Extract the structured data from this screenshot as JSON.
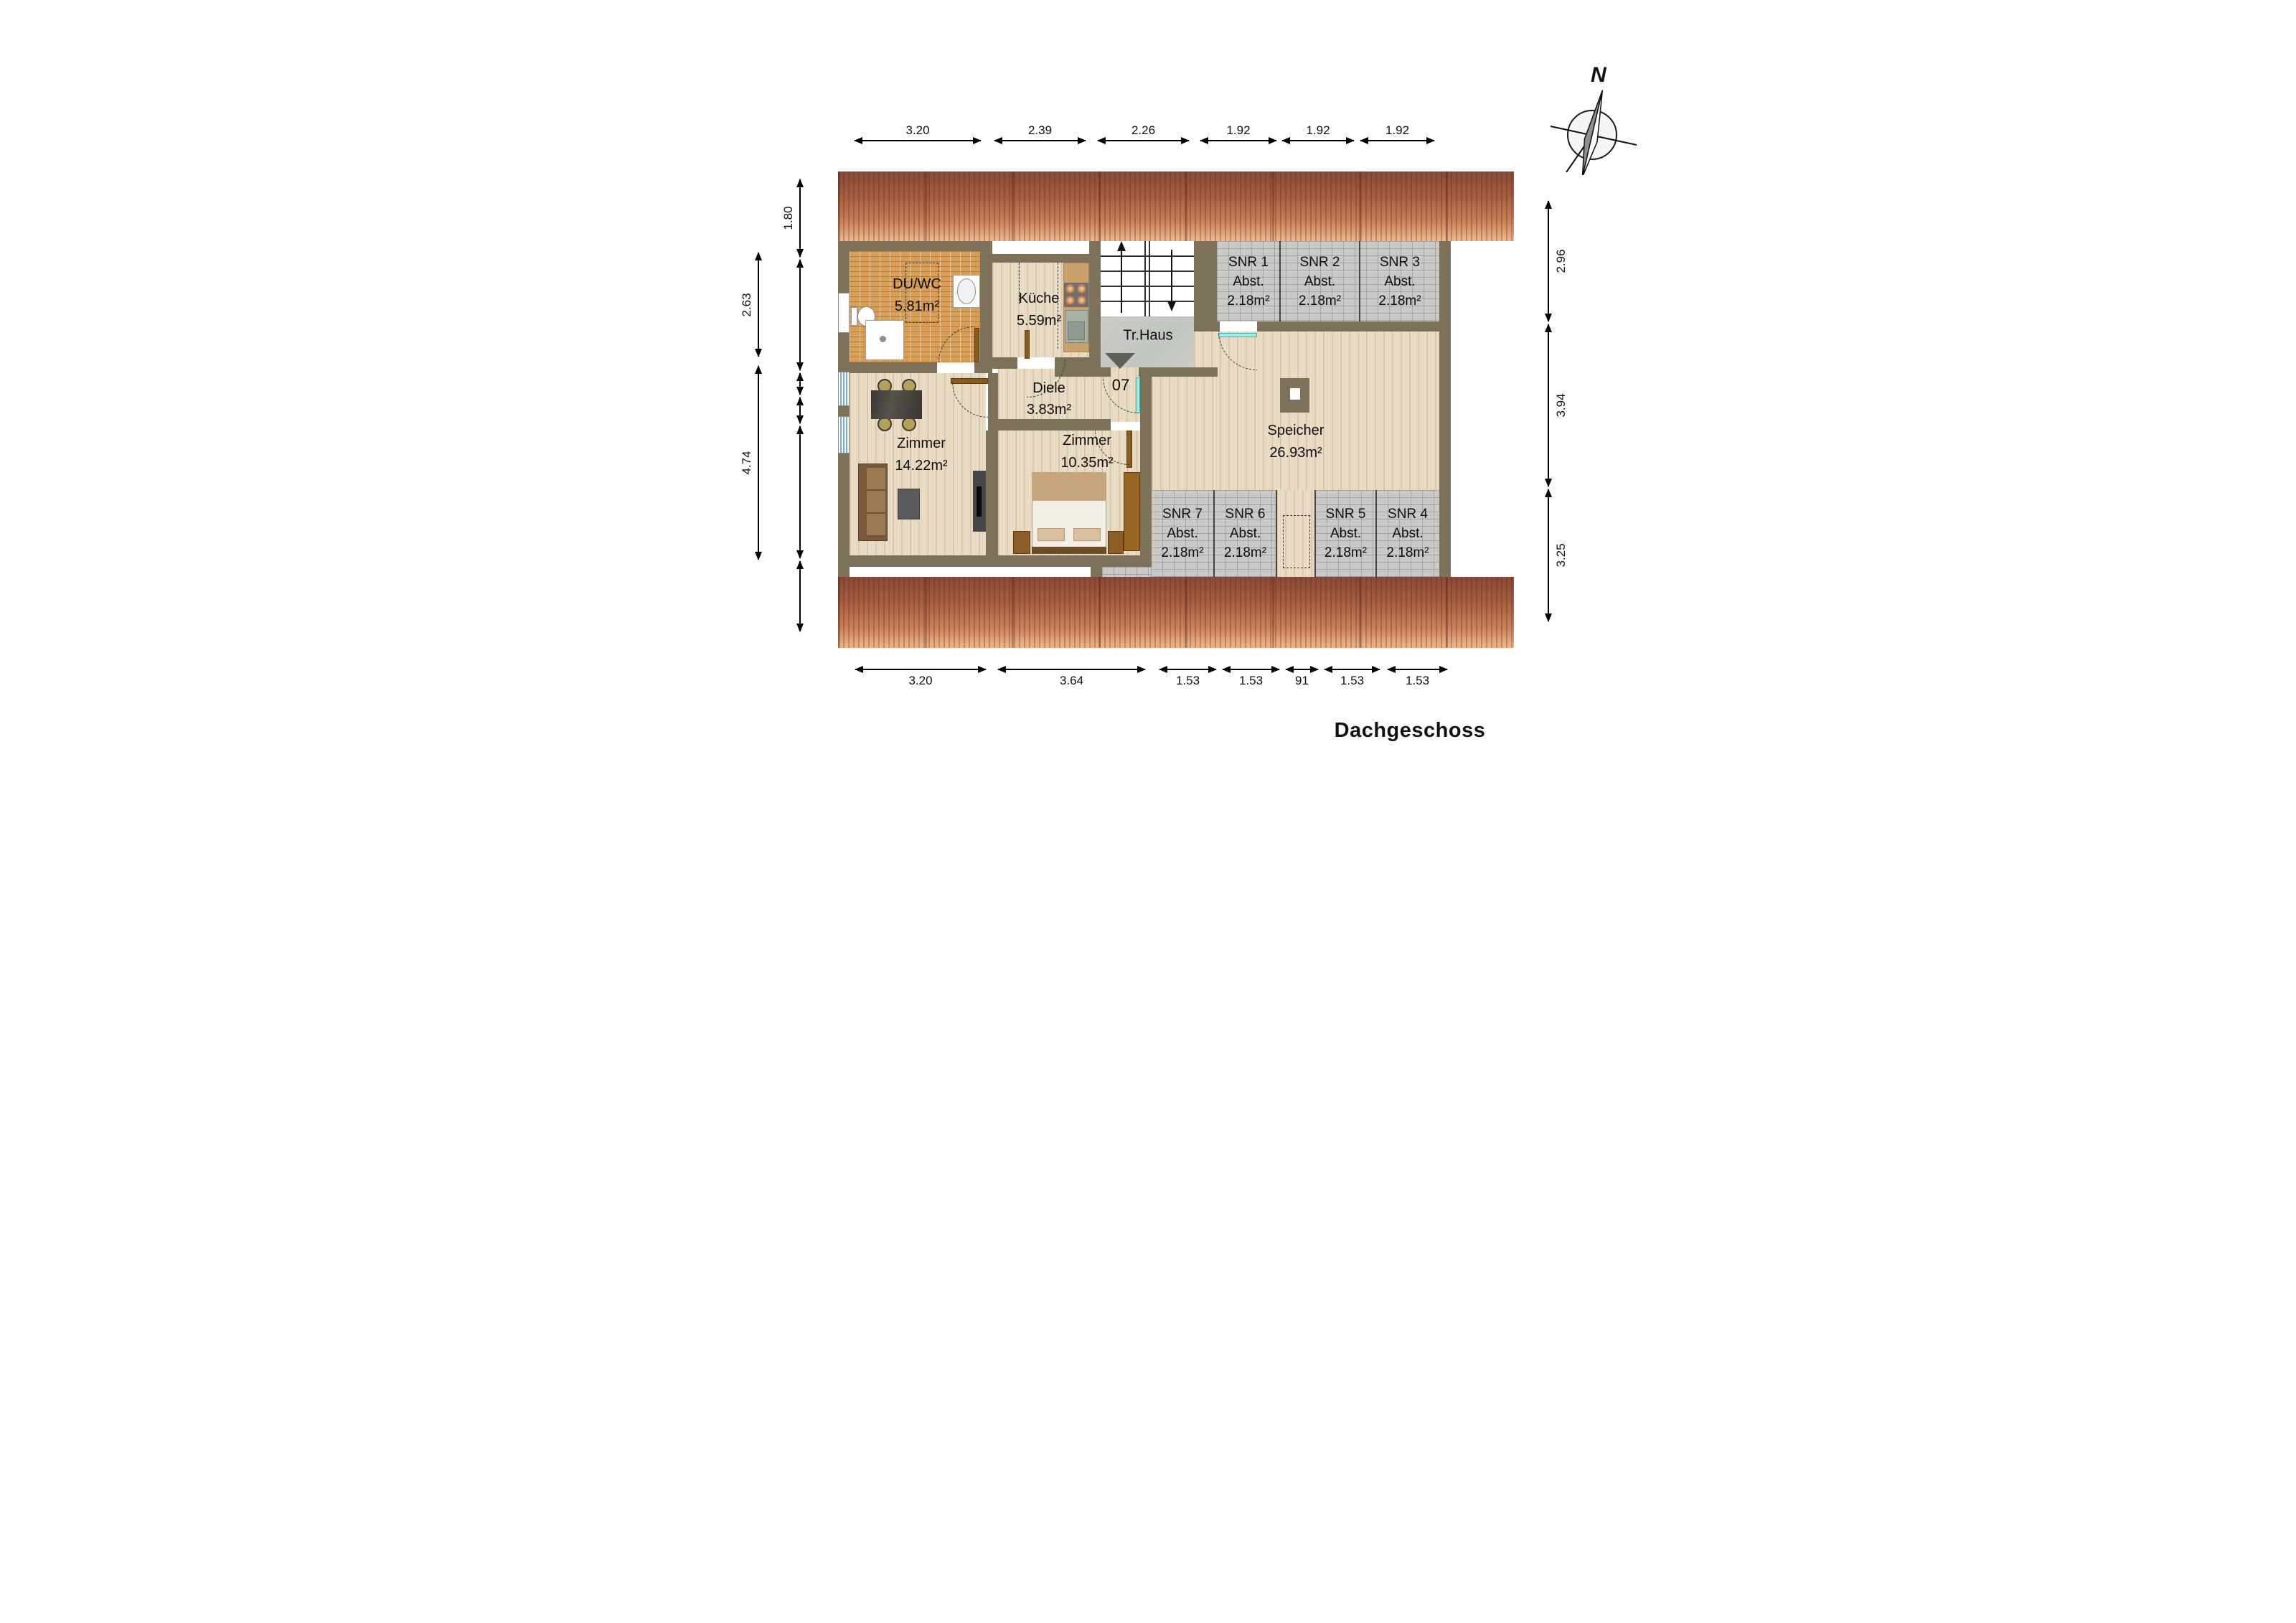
{
  "title": "Dachgeschoss",
  "compass": {
    "label": "N"
  },
  "rooms": {
    "duwc": {
      "name": "DU/WC",
      "area": "5.81m²"
    },
    "kueche": {
      "name": "Küche",
      "area": "5.59m²"
    },
    "trhaus": {
      "name": "Tr.Haus"
    },
    "diele": {
      "name": "Diele",
      "area": "3.83m²"
    },
    "zimmer1": {
      "name": "Zimmer",
      "area": "14.22m²"
    },
    "zimmer2": {
      "name": "Zimmer",
      "area": "10.35m²"
    },
    "speicher": {
      "name": "Speicher",
      "area": "26.93m²"
    },
    "apartment_number": "07"
  },
  "storage_rooms": [
    {
      "name": "SNR 1",
      "label": "Abst.",
      "area": "2.18m²"
    },
    {
      "name": "SNR 2",
      "label": "Abst.",
      "area": "2.18m²"
    },
    {
      "name": "SNR 3",
      "label": "Abst.",
      "area": "2.18m²"
    },
    {
      "name": "SNR 4",
      "label": "Abst.",
      "area": "2.18m²"
    },
    {
      "name": "SNR 5",
      "label": "Abst.",
      "area": "2.18m²"
    },
    {
      "name": "SNR 6",
      "label": "Abst.",
      "area": "2.18m²"
    },
    {
      "name": "SNR 7",
      "label": "Abst.",
      "area": "2.18m²"
    }
  ],
  "dimensions": {
    "top": [
      "3.20",
      "2.39",
      "2.26",
      "1.92",
      "1.92",
      "1.92"
    ],
    "bottom": [
      "3.20",
      "3.64",
      "1.53",
      "1.53",
      "91",
      "1.53",
      "1.53"
    ],
    "left_outer": [
      "2.63",
      "4.74"
    ],
    "left_inner": [
      "1.80"
    ],
    "right": [
      "2.96",
      "3.94",
      "3.25"
    ]
  },
  "colors": {
    "wall": "#7d7259",
    "roof": "#a55e41",
    "orange_tile": "#d89e55",
    "gray_tile": "#c9c9c7",
    "wood": "#e9ddc6",
    "door": "#8a5a20",
    "entry_door": "#9beeea"
  }
}
